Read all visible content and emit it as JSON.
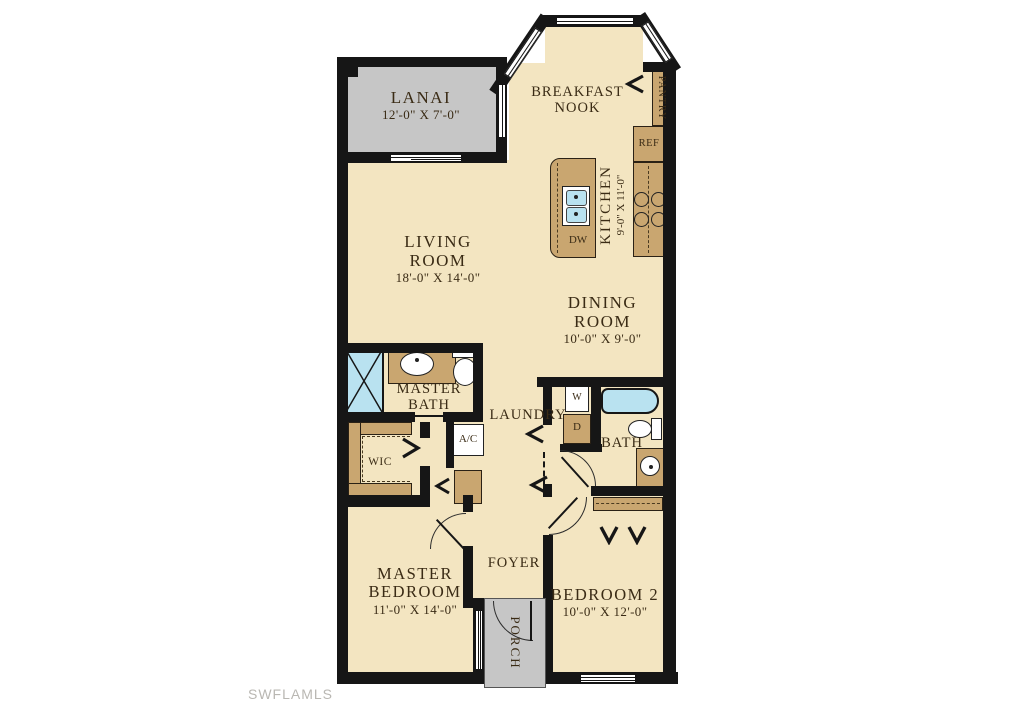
{
  "colors": {
    "wall": "#161616",
    "floor": "#f3e5c1",
    "outdoor": "#c6c6c6",
    "cabinet": "#c9a670",
    "water": "#b9e2f0",
    "label_text": "#3a2b15",
    "watermark": "#b9b7b2"
  },
  "rooms": {
    "lanai": {
      "name": "LANAI",
      "dims": "12'-0\" X 7'-0\""
    },
    "breakfast_nook": {
      "name": "BREAKFAST NOOK"
    },
    "pantry": {
      "name": "PANTRY"
    },
    "kitchen": {
      "name": "KITCHEN",
      "dims": "9'-0\" X 11'-0\""
    },
    "living_room": {
      "name": "LIVING ROOM",
      "dims": "18'-0\" X 14'-0\""
    },
    "dining_room": {
      "name": "DINING ROOM",
      "dims": "10'-0\" X 9'-0\""
    },
    "master_bath": {
      "name": "MASTER BATH"
    },
    "laundry": {
      "name": "LAUNDRY"
    },
    "bath": {
      "name": "BATH"
    },
    "wic": {
      "name": "WIC"
    },
    "ac_closet": {
      "name": "A/C"
    },
    "foyer": {
      "name": "FOYER"
    },
    "porch": {
      "name": "PORCH"
    },
    "master_bedroom": {
      "name": "MASTER BEDROOM",
      "dims": "11'-0\" X 14'-0\""
    },
    "bedroom2": {
      "name": "BEDROOM 2",
      "dims": "10'-0\" X 12'-0\""
    }
  },
  "appliances": {
    "refrigerator": "REF",
    "dishwasher": "DW",
    "washer": "W",
    "dryer": "D"
  },
  "watermark": "SWFLAMLS"
}
